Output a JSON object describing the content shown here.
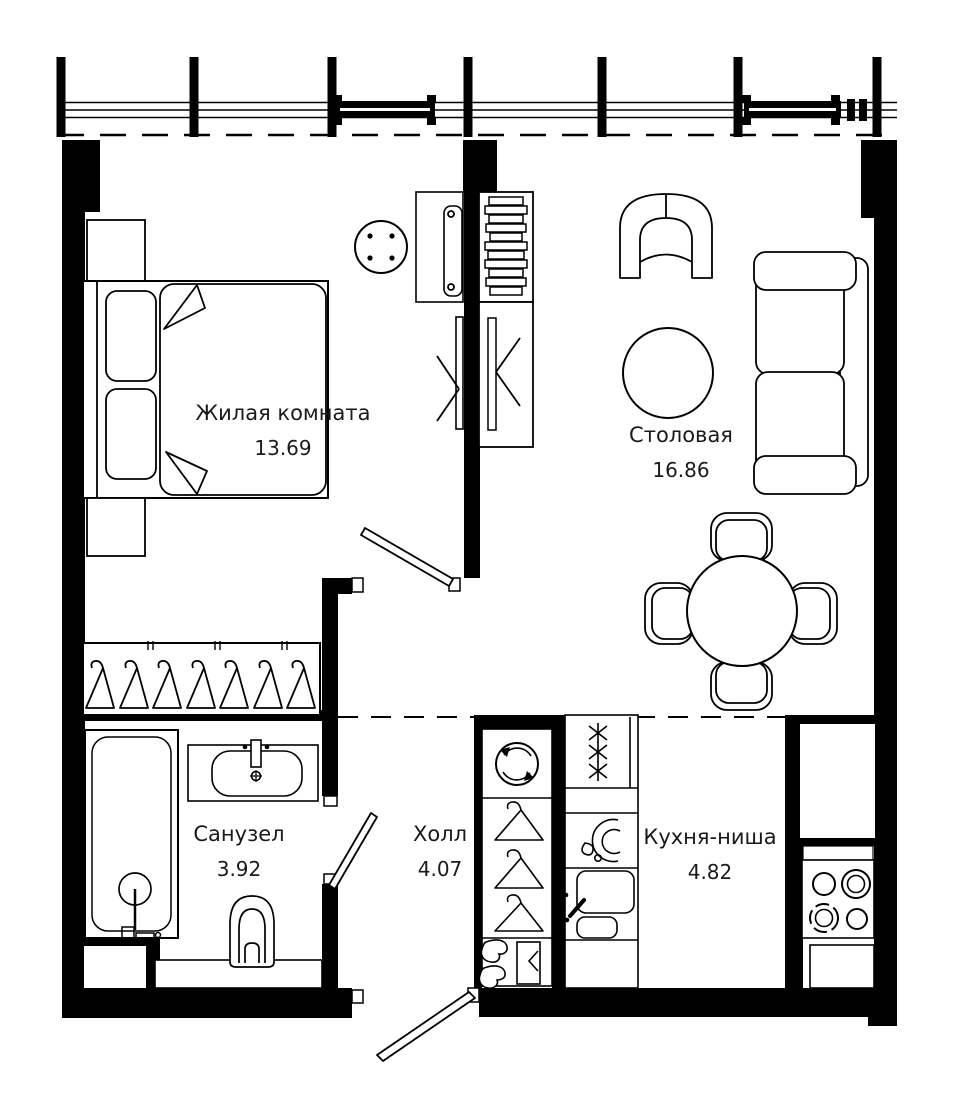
{
  "plan": {
    "type": "apartment-floor-plan",
    "units": "m2"
  },
  "rooms": [
    {
      "id": "living",
      "name": "Жилая комната",
      "area": "13.69"
    },
    {
      "id": "dining",
      "name": "Столовая",
      "area": "16.86"
    },
    {
      "id": "bathroom",
      "name": "Санузел",
      "area": "3.92"
    },
    {
      "id": "hall",
      "name": "Холл",
      "area": "4.07"
    },
    {
      "id": "kitchen",
      "name": "Кухня-ниша",
      "area": "4.82"
    }
  ],
  "fixtures": [
    "double-bed",
    "nightstand",
    "side-table",
    "desk",
    "desk-chair",
    "tv-panel",
    "shelf-unit",
    "wardrobe",
    "hanger-rail",
    "armchair",
    "sofa",
    "rug",
    "dining-table",
    "dining-chairs",
    "washing-machine",
    "closet-hangers",
    "shoe-shelf",
    "fridge-unit",
    "dish-unit",
    "kitchen-sink",
    "stove",
    "bathtub",
    "shower",
    "wash-basin",
    "toilet",
    "entrance-door",
    "bathroom-door",
    "living-room-door",
    "glazed-facade",
    "ventilation-shaft"
  ],
  "colors": {
    "walls": "#000000",
    "lines": "#000000",
    "background": "#ffffff",
    "text": "#1a1a1a"
  }
}
